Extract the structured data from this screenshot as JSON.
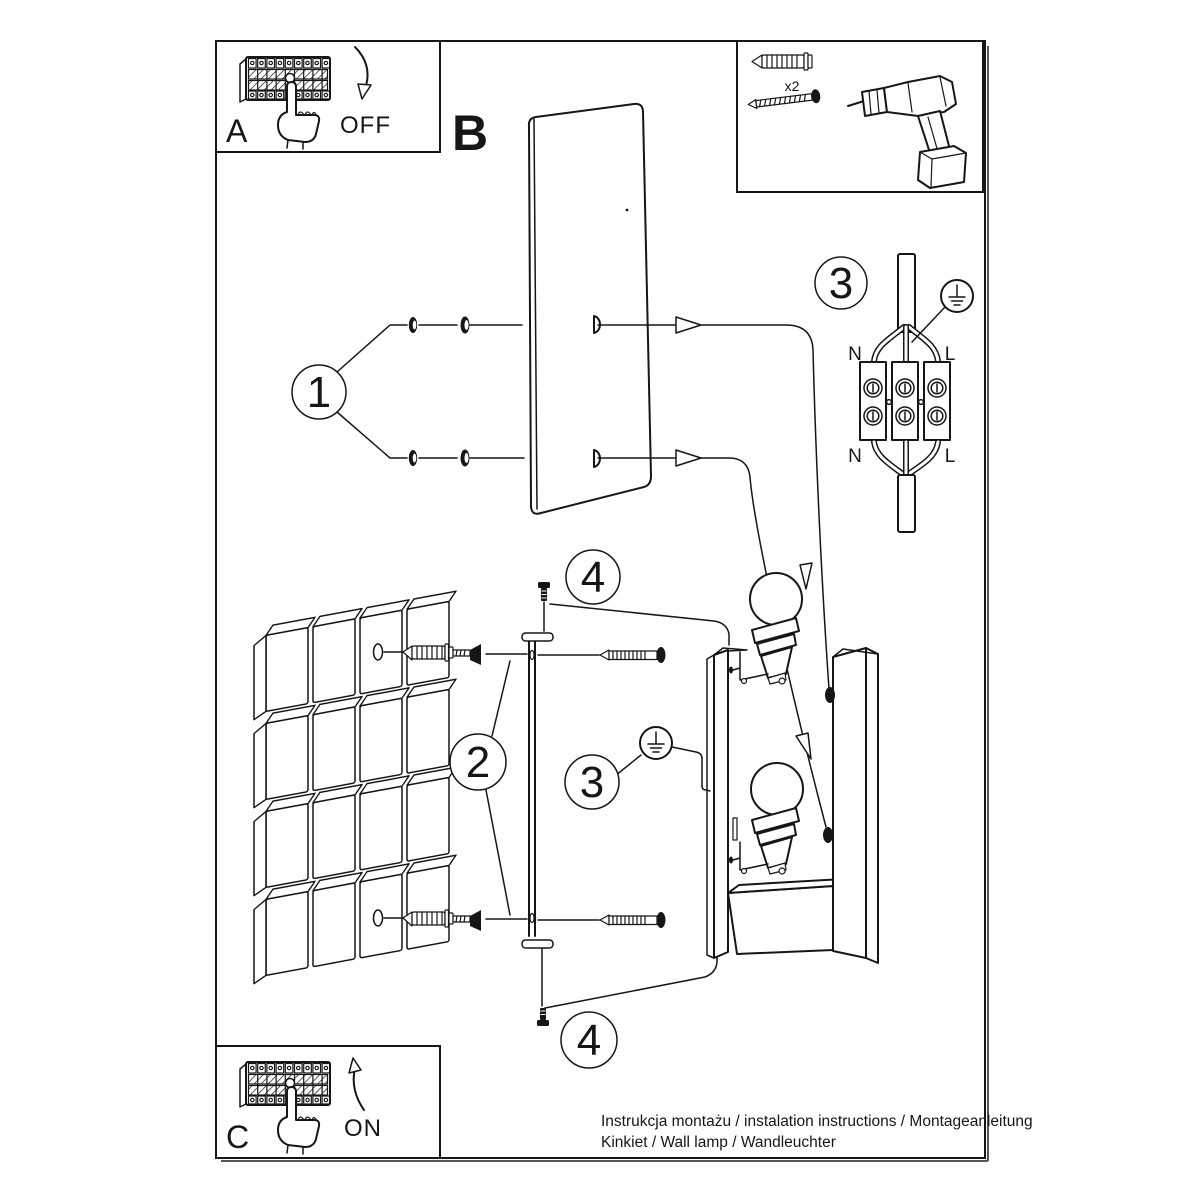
{
  "document": {
    "footer_line1": "Instrukcja montażu / instalation instructions / Montageanleitung",
    "footer_line2": "Kinkiet / Wall lamp / Wandleuchter"
  },
  "steps": {
    "power_off": {
      "label": "A",
      "state": "OFF"
    },
    "cover_plate": {
      "label": "B"
    },
    "step_1": "1",
    "step_2": "2",
    "step_3": "3",
    "step_4": "4",
    "power_on": {
      "label": "C",
      "state": "ON"
    }
  },
  "hardware": {
    "anchor_qty": "x2"
  },
  "wiring": {
    "neutral": "N",
    "live": "L"
  },
  "colors": {
    "line": "#161616",
    "paper": "#ffffff"
  }
}
